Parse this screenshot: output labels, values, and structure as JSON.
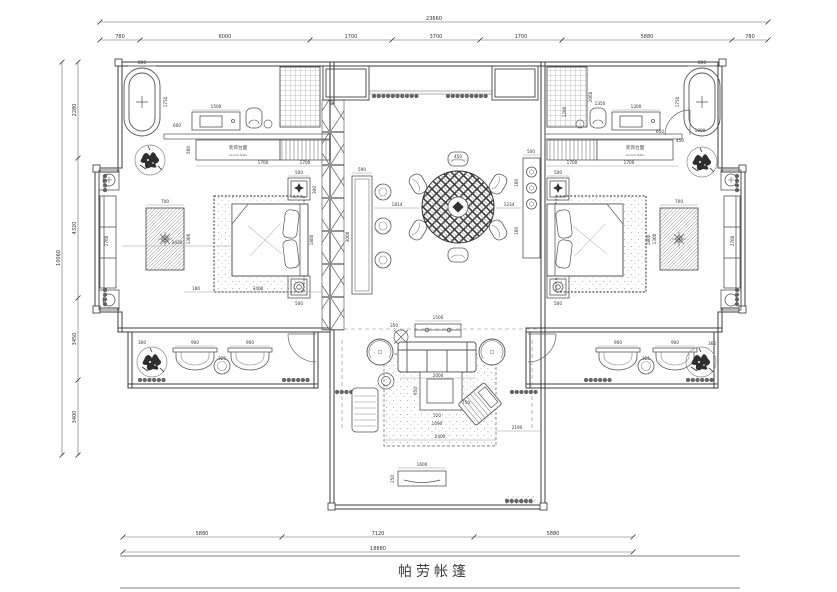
{
  "drawing": {
    "title": "帕劳帐篷",
    "labels": {
      "accent_cn": "装饰台面",
      "accent_en": "Accent Table"
    },
    "dims": {
      "top_total": "23660",
      "top_1": "780",
      "top_2": "6000",
      "top_3": "1700",
      "top_4": "3700",
      "top_5": "1700",
      "top_6": "5880",
      "top_7": "780",
      "bottom_1": "5880",
      "bottom_2": "7120",
      "bottom_3": "5880",
      "bottom_total": "18880",
      "left_1": "2280",
      "left_2": "4320",
      "left_3": "3450",
      "left_4": "3400",
      "left_total": "10060",
      "tub_w_left": "800",
      "tub_len_left": "1750",
      "tub_w_right": "800",
      "tub_len_right": "1750",
      "tub_gap_right": "1000",
      "dresser_left": "1500",
      "dresser_gap_left": "600",
      "dresser_right": "1300",
      "dresser_chair_right": "1350",
      "shower_right_h": "2060",
      "shower_right_w": "1200",
      "door_right_a": "650",
      "door_right_b": "450",
      "accent_left_1": "1700",
      "accent_left_2": "1700",
      "accent_depth_left": "500",
      "accent_right_1": "1700",
      "accent_right_2": "1700",
      "bed_left_width": "2430",
      "bed_left_len": "1800",
      "bed_right_len": "1800",
      "ns_top_left": "500",
      "ns_bottom_left": "500",
      "ns_depth_left": "300",
      "ns_top_right": "500",
      "ns_bottom_right": "500",
      "bench_left": "2700",
      "bench_right": "2700",
      "sidetable_w_left": "700",
      "sidetable_len_left": "1300",
      "sidetable_w_right": "700",
      "sidetable_len_right": "1300",
      "bed_wall_gap_left": "3400",
      "sidetable_gap_left": "180",
      "basin_left_1": "900",
      "basin_left_2": "900",
      "basin_stool_left": "325",
      "bath_gap_left": "300",
      "basin_right_1": "900",
      "basin_right_2": "900",
      "basin_stool_right": "325",
      "plant_right": "365",
      "bar_width": "590",
      "bar_length": "3000",
      "bar_table_gap": "1814",
      "dining_chair": "450",
      "table_console_gap": "1234",
      "console_right_w": "500",
      "console_right_seg1": "160",
      "console_right_seg2": "160",
      "sofa_console": "1500",
      "lamp_gap": "350",
      "sofa_width": "2000",
      "coffee_depth": "650",
      "coffee_width": "520",
      "coffee_gap": "1090",
      "rug_width": "2400",
      "rug_wall_gap": "2190",
      "armchair": "750",
      "porch_console_w": "1600",
      "porch_console_d": "250"
    }
  }
}
